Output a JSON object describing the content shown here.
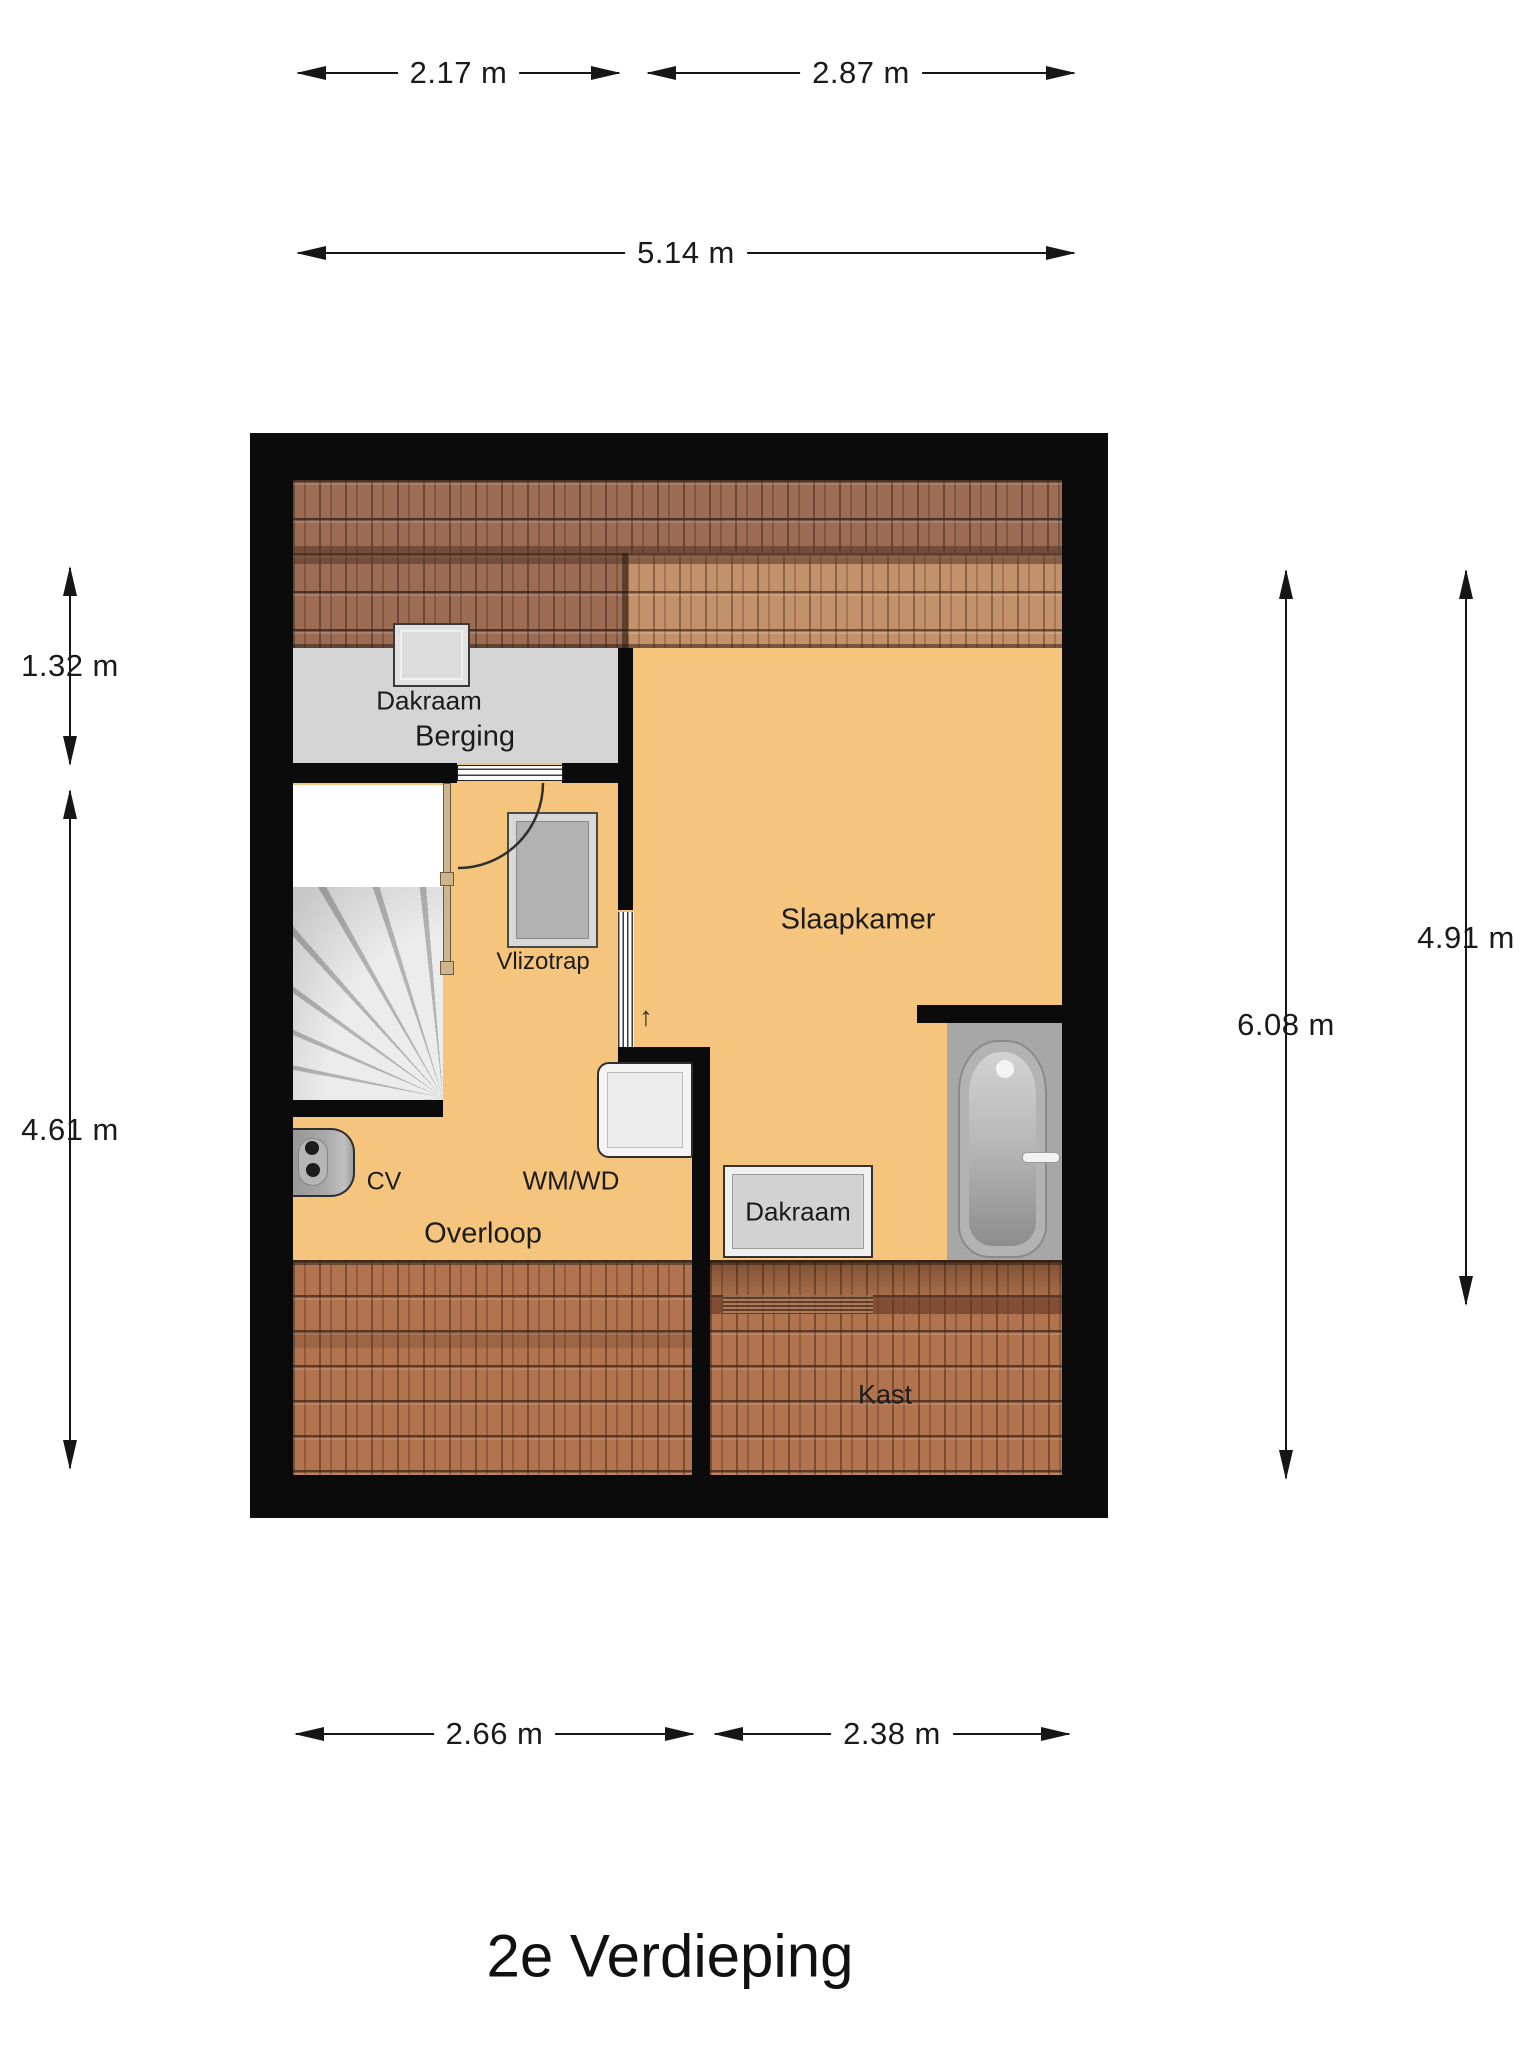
{
  "title": "2e Verdieping",
  "rooms": {
    "berging": {
      "label": "Berging"
    },
    "slaapkamer": {
      "label": "Slaapkamer"
    },
    "overloop": {
      "label": "Overloop"
    },
    "kast": {
      "label": "Kast"
    }
  },
  "features": {
    "dakraam_top": {
      "label": "Dakraam"
    },
    "dakraam_bottom": {
      "label": "Dakraam"
    },
    "vlizotrap": {
      "label": "Vlizotrap"
    },
    "cv": {
      "label": "CV"
    },
    "wm_wd": {
      "label": "WM/WD"
    },
    "stairs_up_arrow": {
      "glyph": "↑"
    }
  },
  "dimensions": {
    "top_left": {
      "label": "2.17 m"
    },
    "top_right": {
      "label": "2.87 m"
    },
    "top_total": {
      "label": "5.14 m"
    },
    "bottom_left": {
      "label": "2.66 m"
    },
    "bottom_right": {
      "label": "2.38 m"
    },
    "left_upper": {
      "label": "1.32 m"
    },
    "left_lower": {
      "label": "4.61 m"
    },
    "right_total": {
      "label": "6.08 m"
    },
    "right_partial": {
      "label": "4.91 m"
    }
  },
  "colors": {
    "floor_orange": "#f5c57e",
    "floor_gray": "#d5d5d5",
    "bath_floor_gray": "#a7a7a7",
    "wall_black": "#0b0b0b",
    "roof_dark": "#9c6d54",
    "roof_light": "#c4926a",
    "roof_bottom": "#b1744e",
    "dim_line": "#161616"
  }
}
